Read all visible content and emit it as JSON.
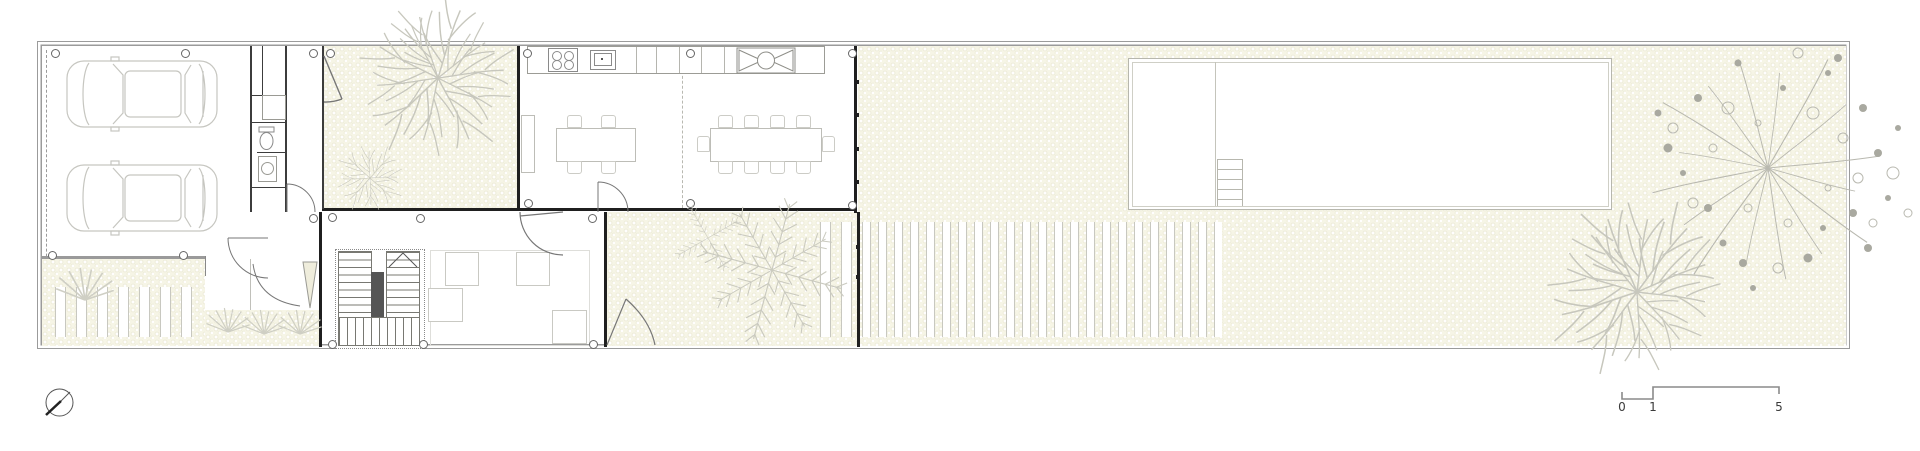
{
  "drawing": {
    "type": "architectural-floor-plan",
    "scale_bar": {
      "labels": [
        "0",
        "1",
        "5"
      ]
    },
    "colors": {
      "background": "#ffffff",
      "paving": "#f6f5e6",
      "wall": "#1f1f1f",
      "boundary": "#9b9b9b",
      "furniture_outline": "#c9c9c3",
      "vegetation": "#c7c7bd",
      "pool_outline": "#b7b7ae"
    },
    "symbols": [
      "north-arrow",
      "scale-bar",
      "car",
      "tree-branching",
      "tree-fern",
      "tree-dandelion",
      "grass-tuft",
      "swimming-pool",
      "pool-ladder",
      "stair",
      "toilet",
      "basin",
      "stove",
      "sink",
      "rangehood",
      "dining-table",
      "island-bench",
      "sofa",
      "column-marker",
      "door-swing",
      "deck-strips",
      "paver-strips"
    ]
  }
}
